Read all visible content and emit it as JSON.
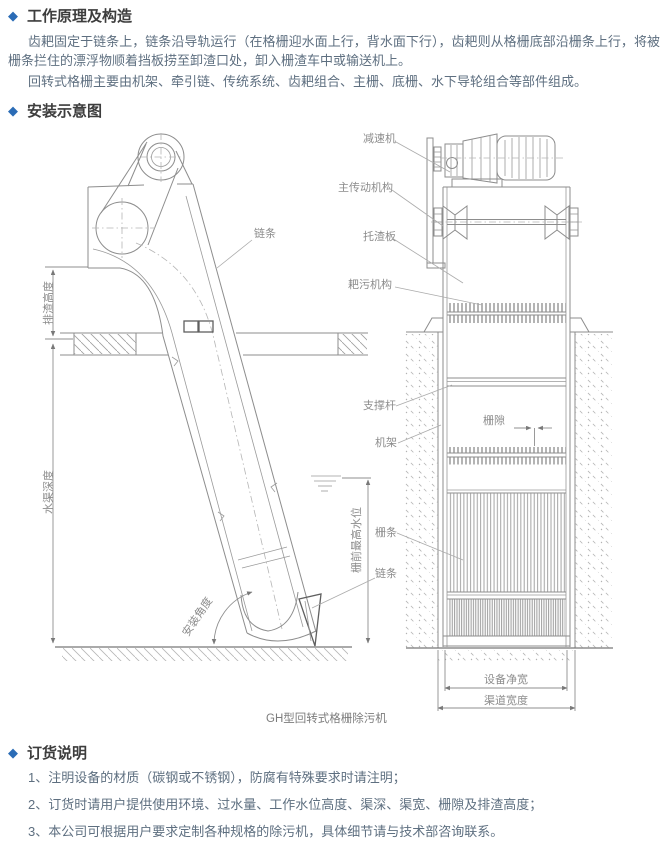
{
  "page": {
    "background": "#ffffff",
    "accent_blue": "#2b6cb6",
    "body_text_color": "#5e6f80",
    "drawing_line_color": "#8d8d8d"
  },
  "sections": {
    "principle": {
      "bullet": "◆",
      "title": "工作原理及构造",
      "para1": "齿耙固定于链条上，链条沿导轨运行（在格栅迎水面上行，背水面下行），齿耙则从格栅底部沿栅条上行，将被栅条拦住的漂浮物顺着挡板捞至卸渣口处，卸入栅渣车中或输送机上。",
      "para2": "回转式格栅主要由机架、牵引链、传统系统、齿耙组合、主栅、底栅、水下导轮组合等部件组成。"
    },
    "diagram": {
      "bullet": "◆",
      "title": "安装示意图",
      "caption": "GH型回转式格栅除污机",
      "labels": {
        "reducer": "减速机",
        "main_drive": "主传动机构",
        "slag_plate": "托渣板",
        "rake_mechanism": "耙污机构",
        "support_rod": "支撑杆",
        "frame": "机架",
        "grid_bar": "栅条",
        "chain_right": "链条",
        "chain_left": "链条",
        "grid_gap": "栅隙",
        "discharge_height": "排渣高度",
        "channel_depth": "水渠深度",
        "max_water_level": "栅前最高水位",
        "install_angle": "安装角度",
        "equipment_width": "设备净宽",
        "channel_width": "渠道宽度"
      }
    },
    "ordering": {
      "bullet": "◆",
      "title": "订货说明",
      "items": [
        "1、注明设备的材质（碳钢或不锈钢），防腐有特殊要求时请注明；",
        "2、订货时请用户提供使用环境、过水量、工作水位高度、渠深、渠宽、栅隙及排渣高度；",
        "3、本公司可根据用户要求定制各种规格的除污机，具体细节请与技术部咨询联系。"
      ]
    }
  }
}
